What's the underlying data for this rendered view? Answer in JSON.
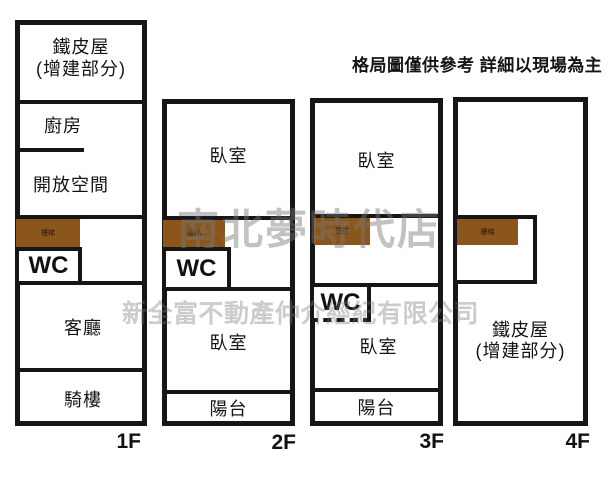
{
  "disclaimer": "格局圖僅供參考 詳細以現場為主",
  "watermarks": {
    "store": "南北夢時代店",
    "company": "新全富不動產仲介經紀有限公司"
  },
  "colors": {
    "wall": "#161616",
    "stair_fill": "#8a561b",
    "watermark_gray": "#c6c6c6",
    "background": "#ffffff"
  },
  "floors": [
    {
      "label": "1F",
      "rooms": {
        "tin_line1": "鐵皮屋",
        "tin_line2": "(增建部分)",
        "kitchen": "廚房",
        "open_space": "開放空間",
        "stairs": "樓梯",
        "wc": "WC",
        "living_room": "客廳",
        "arcade": "騎樓"
      }
    },
    {
      "label": "2F",
      "rooms": {
        "bedroom_upper": "臥室",
        "stairs": "樓梯",
        "wc": "WC",
        "bedroom_lower": "臥室",
        "balcony": "陽台"
      }
    },
    {
      "label": "3F",
      "rooms": {
        "bedroom_upper": "臥室",
        "stairs": "樓梯",
        "wc": "WC",
        "bedroom_lower": "臥室",
        "balcony": "陽台"
      }
    },
    {
      "label": "4F",
      "rooms": {
        "stairs": "樓梯",
        "tin_line1": "鐵皮屋",
        "tin_line2": "(增建部分)"
      }
    }
  ]
}
